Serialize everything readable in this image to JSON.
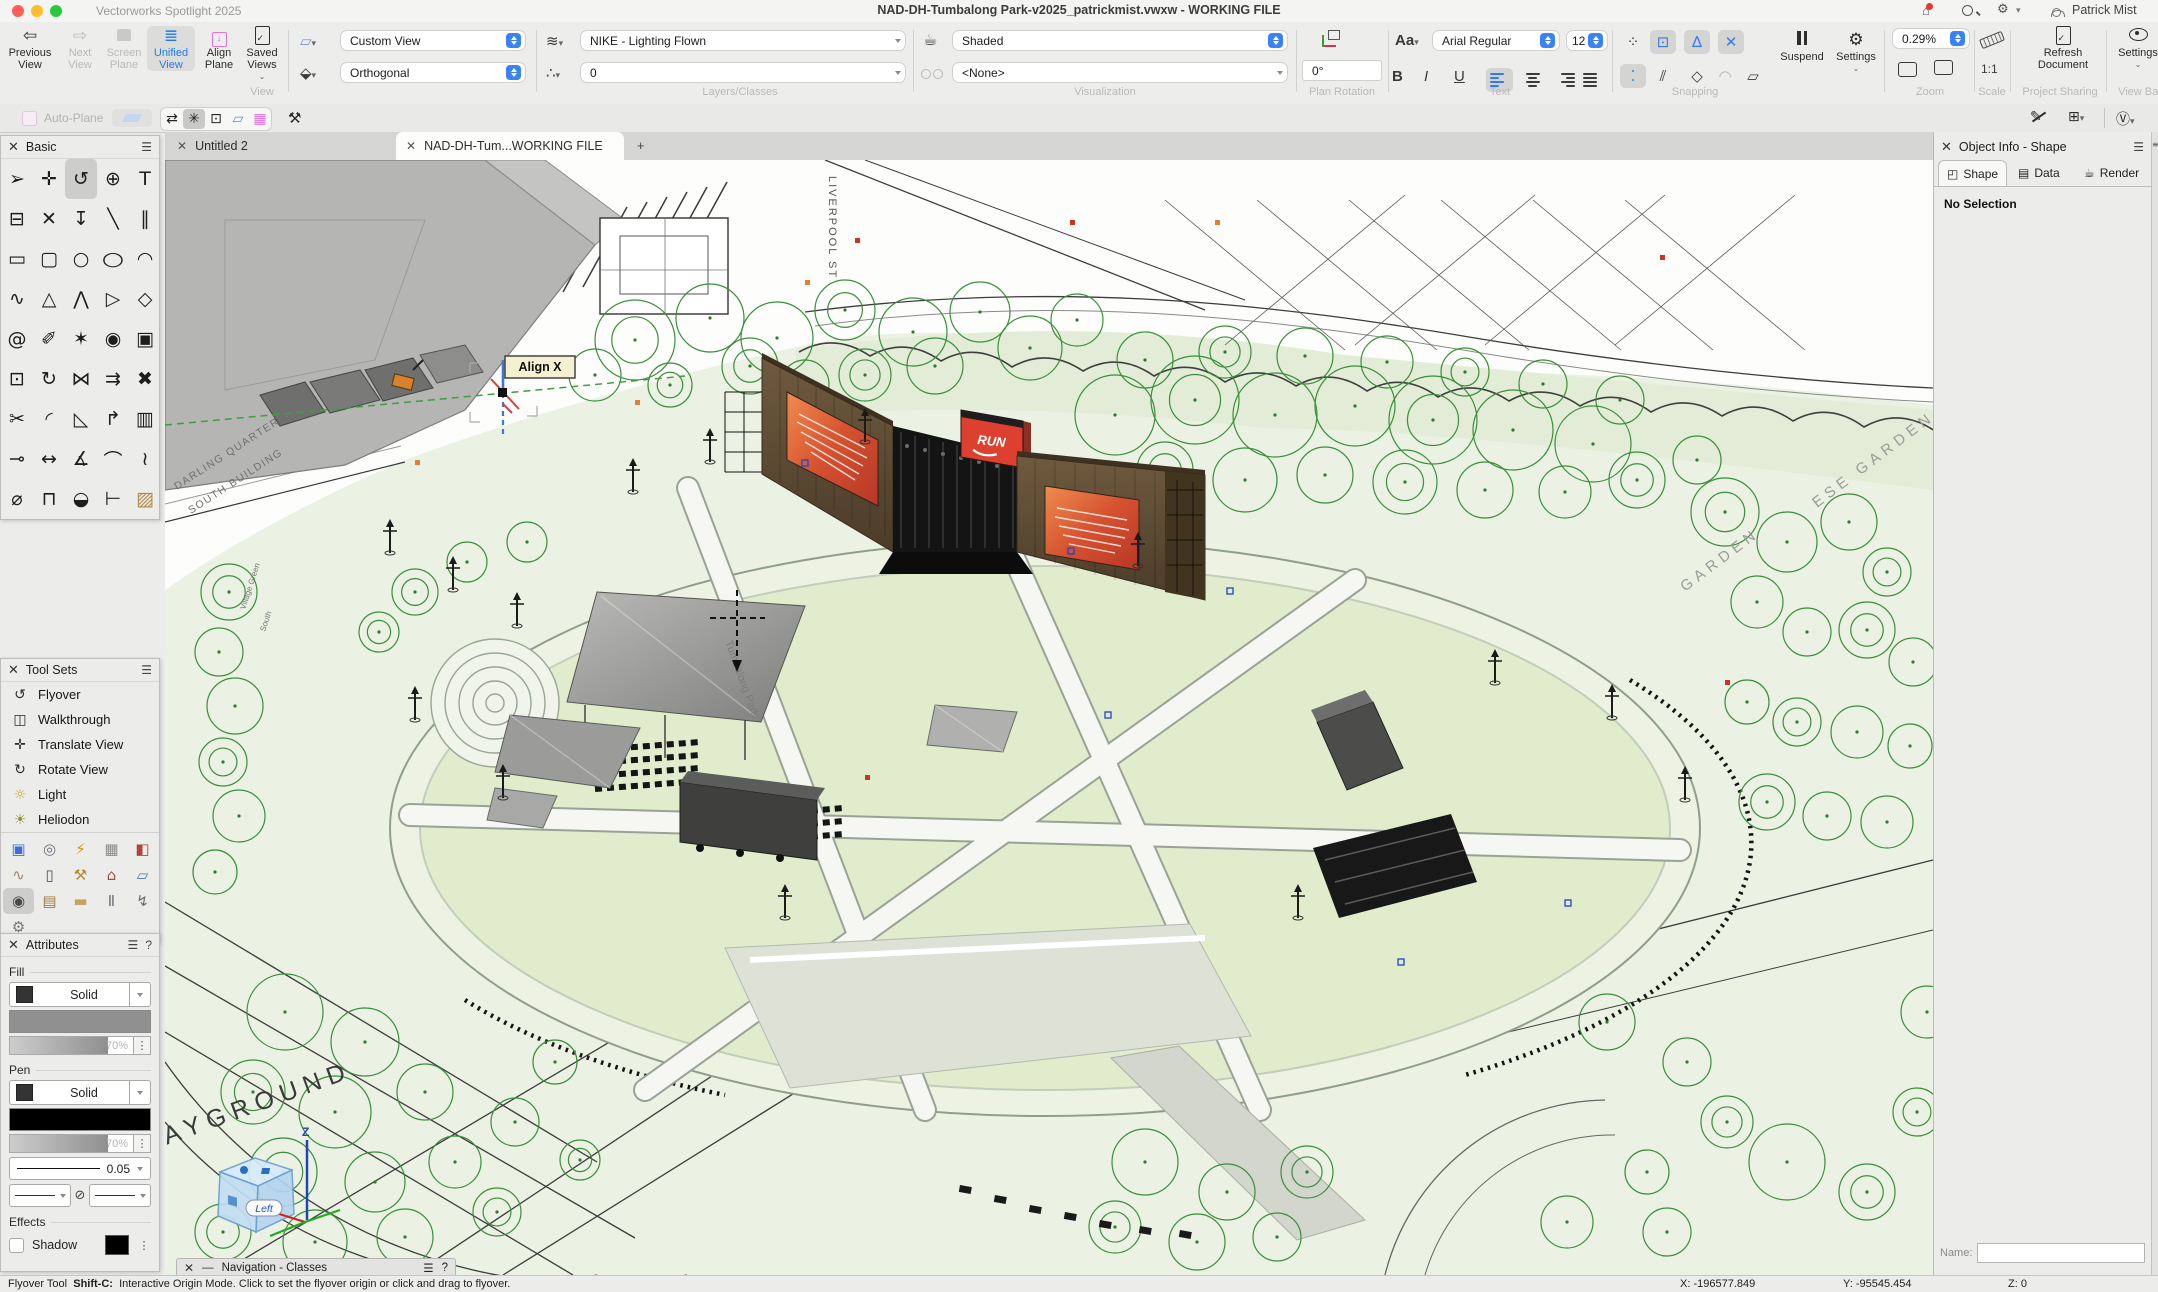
{
  "window": {
    "app_name": "Vectorworks Spotlight 2025",
    "title": "NAD-DH-Tumbalong Park-v2025_patrickmist.vwxw - WORKING FILE",
    "user": "Patrick Mist"
  },
  "view_bar": {
    "buttons": {
      "previous": "Previous View",
      "next": "Next View",
      "screen_plane": "Screen Plane",
      "unified": "Unified View",
      "align_plane": "Align Plane",
      "saved_views": "Saved Views"
    },
    "group_labels": {
      "view": "View",
      "layers": "Layers/Classes",
      "visualization": "Visualization",
      "plan_rotation": "Plan Rotation",
      "text": "Text",
      "snapping": "Snapping",
      "zoom": "Zoom",
      "scale": "Scale",
      "project": "Project Sharing",
      "view_bar": "View Bar"
    },
    "dropdowns": {
      "view_preset": "Custom View",
      "projection": "Orthogonal",
      "layer": "NIKE - Lighting Flown",
      "class": "0",
      "render_mode": "Shaded",
      "data_vis": "<None>",
      "font": "Arial Regular",
      "font_size": "12",
      "zoom_level": "0.29%"
    },
    "plan_rotation_value": "0°",
    "text_buttons": {
      "bold": "B",
      "italic": "I",
      "underline": "U"
    },
    "snapping": {
      "suspend": "Suspend",
      "settings": "Settings"
    },
    "scale_value": "1:1",
    "project_button": "Refresh Document",
    "view_bar_settings": "Settings"
  },
  "mode_bar": {
    "auto_plane": "Auto-Plane"
  },
  "tabs": {
    "untitled": "Untitled 2",
    "working": "NAD-DH-Tum...WORKING FILE",
    "add": "+"
  },
  "basic_palette": {
    "title": "Basic",
    "tools": [
      {
        "n": "selection",
        "g": "➢"
      },
      {
        "n": "pan",
        "g": "✛"
      },
      {
        "n": "flyover",
        "g": "↺",
        "sel": true
      },
      {
        "n": "zoom",
        "g": "⊕"
      },
      {
        "n": "text",
        "g": "T"
      },
      {
        "n": "callout",
        "g": "⊟"
      },
      {
        "n": "snap-point",
        "g": "✕"
      },
      {
        "n": "send-to-surface",
        "g": "↧"
      },
      {
        "n": "line",
        "g": "╲"
      },
      {
        "n": "double-line",
        "g": "∥"
      },
      {
        "n": "rectangle",
        "g": "▭"
      },
      {
        "n": "rounded-rectangle",
        "g": "▢"
      },
      {
        "n": "circle",
        "g": "○"
      },
      {
        "n": "oval",
        "g": "○",
        "cls": "wide"
      },
      {
        "n": "arc",
        "g": "◠"
      },
      {
        "n": "freehand",
        "g": "∿"
      },
      {
        "n": "polygon",
        "g": "△"
      },
      {
        "n": "polyline",
        "g": "⋀"
      },
      {
        "n": "closed-polygon",
        "g": "▷"
      },
      {
        "n": "regular-polygon",
        "g": "◇"
      },
      {
        "n": "spiral",
        "g": "@"
      },
      {
        "n": "eyedropper",
        "g": "✐"
      },
      {
        "n": "magic-wand",
        "g": "✶"
      },
      {
        "n": "select-similar",
        "g": "◉"
      },
      {
        "n": "clip",
        "g": "▣"
      },
      {
        "n": "reshape",
        "g": "⊡"
      },
      {
        "n": "rotate",
        "g": "↻"
      },
      {
        "n": "mirror",
        "g": "⋈"
      },
      {
        "n": "offset",
        "g": "⇉"
      },
      {
        "n": "delete",
        "g": "✖"
      },
      {
        "n": "trim",
        "g": "✂"
      },
      {
        "n": "fillet",
        "g": "◜"
      },
      {
        "n": "chamfer",
        "g": "◺"
      },
      {
        "n": "extend",
        "g": "↱"
      },
      {
        "n": "shell",
        "g": "▥"
      },
      {
        "n": "connect",
        "g": "⊸"
      },
      {
        "n": "linear-dimension",
        "g": "↔"
      },
      {
        "n": "angular-dimension",
        "g": "∡"
      },
      {
        "n": "radial-dimension",
        "g": "⌒"
      },
      {
        "n": "ordinate-dimension",
        "g": "≀"
      },
      {
        "n": "diameter-dimension",
        "g": "⌀"
      },
      {
        "n": "tape-measure",
        "g": "⊓"
      },
      {
        "n": "protractor",
        "g": "◒"
      },
      {
        "n": "section-line",
        "g": "⊢"
      },
      {
        "n": "hatch",
        "g": "▨",
        "cls": "tan"
      }
    ]
  },
  "tool_sets": {
    "title": "Tool Sets",
    "items": [
      {
        "label": "Flyover",
        "g": "↺",
        "c": "#2b2b2b"
      },
      {
        "label": "Walkthrough",
        "g": "◫",
        "c": "#2b2b2b"
      },
      {
        "label": "Translate View",
        "g": "✛",
        "c": "#2b2b2b"
      },
      {
        "label": "Rotate View",
        "g": "↻",
        "c": "#2b2b2b"
      },
      {
        "label": "Light",
        "g": "☼",
        "c": "#d9a714"
      },
      {
        "label": "Heliodon",
        "g": "☀",
        "c": "#8f8f3a"
      }
    ],
    "grid": [
      {
        "n": "video-screen",
        "g": "▣",
        "c": "#3b6ed6"
      },
      {
        "n": "lens",
        "g": "◎",
        "c": "#6a6f7a"
      },
      {
        "n": "power",
        "g": "⚡",
        "c": "#c99a1e"
      },
      {
        "n": "truss",
        "g": "▦",
        "c": "#8a8a8a"
      },
      {
        "n": "stage",
        "g": "◧",
        "c": "#b0443a"
      },
      {
        "n": "cable",
        "g": "∿",
        "c": "#a5854f"
      },
      {
        "n": "distribution-panel",
        "g": "▯",
        "c": "#4a4f58"
      },
      {
        "n": "hand-truck",
        "g": "⚒",
        "c": "#b58a3e"
      },
      {
        "n": "house",
        "g": "⌂",
        "c": "#a84a42"
      },
      {
        "n": "projection-screen",
        "g": "▱",
        "c": "#4a7ab5"
      },
      {
        "n": "video-camera",
        "g": "◉",
        "c": "#4a4a4a",
        "sel": true
      },
      {
        "n": "crate",
        "g": "▤",
        "c": "#a0793d"
      },
      {
        "n": "ruler",
        "g": "▬",
        "c": "#c8a165"
      },
      {
        "n": "steel-beam",
        "g": "Ⅱ",
        "c": "#70747c"
      },
      {
        "n": "bolt",
        "g": "↯",
        "c": "#6a6f76"
      },
      {
        "n": "gears",
        "g": "⚙",
        "c": "#787878"
      }
    ]
  },
  "attributes": {
    "title": "Attributes",
    "fill_label": "Fill",
    "pen_label": "Pen",
    "effects_label": "Effects",
    "fill_style": "Solid",
    "pen_style": "Solid",
    "fill_opacity": "70%",
    "pen_opacity": "70%",
    "line_weight": "0.05",
    "shadow_label": "Shadow"
  },
  "object_info": {
    "title": "Object Info - Shape",
    "tab_shape": "Shape",
    "tab_data": "Data",
    "tab_render": "Render",
    "empty": "No Selection",
    "name_label": "Name:"
  },
  "navigation_palette": {
    "title": "Navigation - Classes"
  },
  "status_bar": {
    "tool": "Flyover Tool",
    "shortcut": "Shift-C:",
    "message": "Interactive Origin Mode. Click to set the flyover origin or click and drag to flyover.",
    "x": "X: -196577.849",
    "y": "Y: -95545.454",
    "z": "Z: 0"
  },
  "canvas_labels": {
    "align_tooltip": "Align X",
    "playground": "PLAYGROUND",
    "garden": "GARDEN",
    "garden2": "ESE GARDEN",
    "building_line1": "DARLING QUARTER",
    "building_line2": "SOUTH BUILDING",
    "park_name": "Tumbalong Park",
    "street": "LIVERPOOL ST",
    "village1": "Village Green",
    "village2": "South",
    "cube_face": "Left",
    "axis_z": "Z",
    "run_sign": "RUN"
  },
  "colors": {
    "accent_blue": "#1f7cf0",
    "macos_badge_blue": "#3b82f7",
    "tree_green": "#3a8f3a",
    "park_green": "#ebf1e3",
    "stage_wood": "#5e4b33",
    "screen_orange": "#e0703f",
    "run_red": "#de4030"
  }
}
